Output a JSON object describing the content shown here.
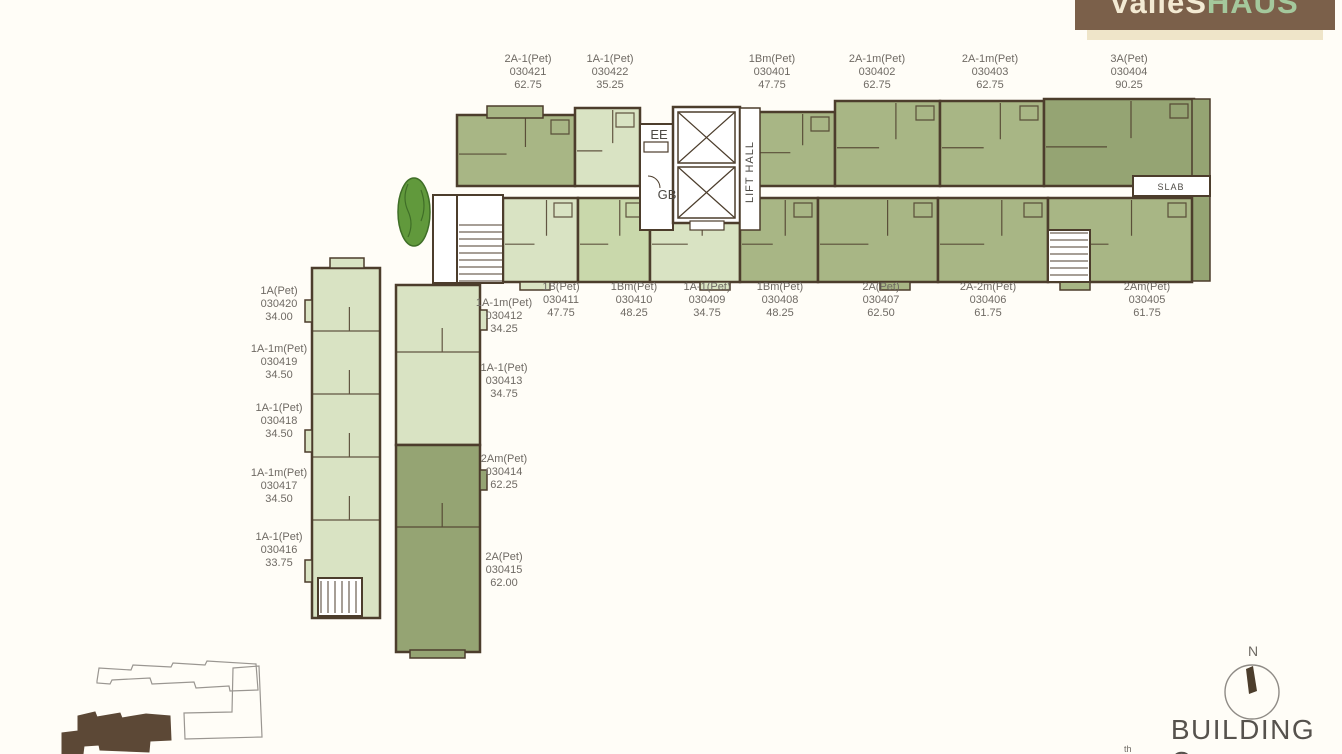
{
  "logo": {
    "brand": "valleS",
    "brand_accent": "HAUS"
  },
  "plan": {
    "ee": "EE",
    "gb": "GB",
    "lift_hall": "LIFT HALL",
    "slab": "SLAB"
  },
  "footer": {
    "building_name": "BUILDING C",
    "compass_north": "N",
    "storey_fragment": "th"
  },
  "units": {
    "top_row": [
      {
        "type": "2A-1(Pet)",
        "number": "030421",
        "area": "62.75"
      },
      {
        "type": "1A-1(Pet)",
        "number": "030422",
        "area": "35.25"
      },
      {
        "type": "1Bm(Pet)",
        "number": "030401",
        "area": "47.75"
      },
      {
        "type": "2A-1m(Pet)",
        "number": "030402",
        "area": "62.75"
      },
      {
        "type": "2A-1m(Pet)",
        "number": "030403",
        "area": "62.75"
      },
      {
        "type": "3A(Pet)",
        "number": "030404",
        "area": "90.25"
      }
    ],
    "middle_row": [
      {
        "type": "1B(Pet)",
        "number": "030411",
        "area": "47.75"
      },
      {
        "type": "1Bm(Pet)",
        "number": "030410",
        "area": "48.25"
      },
      {
        "type": "1A-1(Pet)",
        "number": "030409",
        "area": "34.75"
      },
      {
        "type": "1Bm(Pet)",
        "number": "030408",
        "area": "48.25"
      },
      {
        "type": "2A(Pet)",
        "number": "030407",
        "area": "62.50"
      },
      {
        "type": "2A-2m(Pet)",
        "number": "030406",
        "area": "61.75"
      },
      {
        "type": "2Am(Pet)",
        "number": "030405",
        "area": "61.75"
      }
    ],
    "left_column": [
      {
        "type": "1A(Pet)",
        "number": "030420",
        "area": "34.00"
      },
      {
        "type": "1A-1m(Pet)",
        "number": "030419",
        "area": "34.50"
      },
      {
        "type": "1A-1(Pet)",
        "number": "030418",
        "area": "34.50"
      },
      {
        "type": "1A-1m(Pet)",
        "number": "030417",
        "area": "34.50"
      },
      {
        "type": "1A-1(Pet)",
        "number": "030416",
        "area": "33.75"
      }
    ],
    "inner_column": [
      {
        "type": "1A-1m(Pet)",
        "number": "030412",
        "area": "34.25"
      },
      {
        "type": "1A-1(Pet)",
        "number": "030413",
        "area": "34.75"
      },
      {
        "type": "2Am(Pet)",
        "number": "030414",
        "area": "62.25"
      },
      {
        "type": "2A(Pet)",
        "number": "030415",
        "area": "62.00"
      }
    ]
  },
  "colors": {
    "wall": "#4c3d2c",
    "unit_light": "#d9e3c3",
    "unit_light2": "#c9d8ab",
    "unit_medium": "#a8b685",
    "unit_dark": "#95a473",
    "planter": "#61993c",
    "label_text": "#6f6a64",
    "logo_brown": "#7b604a",
    "logo_cream": "#f2e9d2",
    "logo_green": "#9fc79a",
    "sitemap_brown": "#5c4836",
    "outline_gray": "#9a9691"
  }
}
